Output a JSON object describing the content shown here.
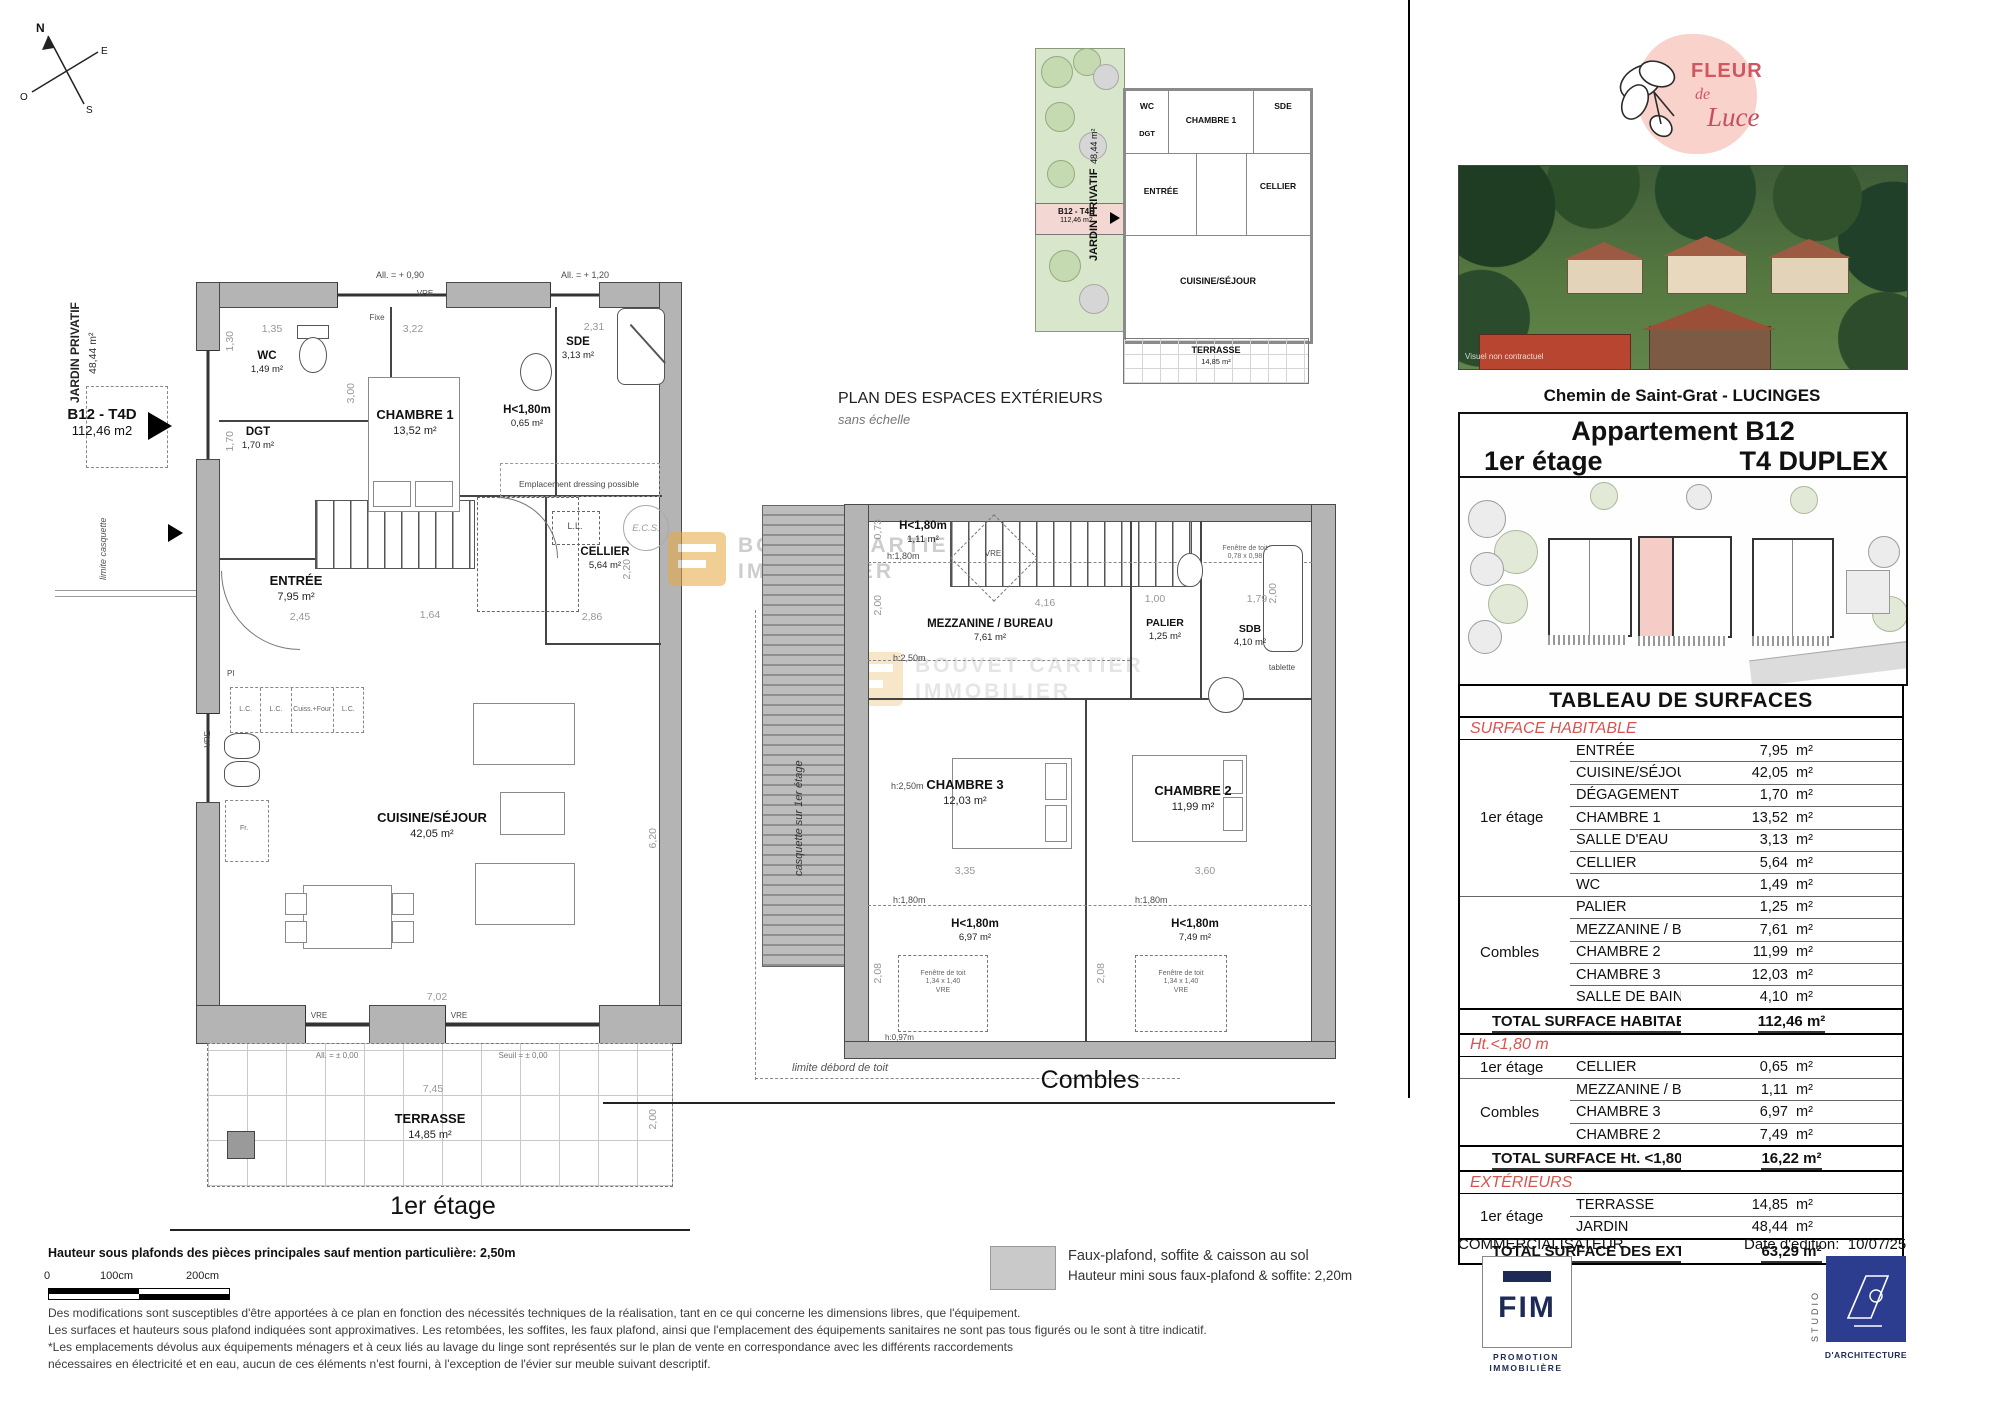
{
  "compass": {
    "n": "N",
    "e": "E",
    "s": "S",
    "o": "O"
  },
  "plan1": {
    "caption": "1er étage",
    "jardin_label": "JARDIN PRIVATIF",
    "jardin_area": "48,44 m²",
    "limite_casquette": "limite casquette",
    "tag_name": "B12 - T4D",
    "tag_area": "112,46 m2",
    "rooms": {
      "wc": {
        "name": "WC",
        "area": "1,49 m²"
      },
      "dgt": {
        "name": "DGT",
        "area": "1,70 m²"
      },
      "ch1": {
        "name": "CHAMBRE 1",
        "area": "13,52 m²"
      },
      "sde": {
        "name": "SDE",
        "area": "3,13 m²"
      },
      "cellier": {
        "name": "CELLIER",
        "area": "5,64 m²"
      },
      "h180": {
        "name": "H<1,80m",
        "area": "0,65 m²"
      },
      "entree": {
        "name": "ENTRÉE",
        "area": "7,95 m²"
      },
      "cuisine": {
        "name": "CUISINE/SÉJOUR",
        "area": "42,05 m²"
      },
      "terrasse": {
        "name": "TERRASSE",
        "area": "14,85 m²"
      }
    },
    "ann": {
      "all090": "All. = + 0,90",
      "all120": "All. = + 1,20",
      "fixe": "Fixe",
      "vre": "VRE",
      "dressing": "Emplacement dressing possible",
      "ll": "L.L.",
      "ecs": "E.C.S.",
      "pi": "PI",
      "lc": "L.C.",
      "cuiss": "Cuiss.+Four",
      "fr": "Fr.",
      "all000": "All. = ± 0,00",
      "seuil": "Seuil = ± 0,00"
    },
    "dims": {
      "d135": "1,35",
      "d322": "3,22",
      "d231": "2,31",
      "d300": "3,00",
      "d130": "1,30",
      "d170": "1,70",
      "d245": "2,45",
      "d164": "1,64",
      "d286": "2,86",
      "d220": "2,20",
      "d620": "6,20",
      "d702": "7,02",
      "d745": "7,45",
      "d200": "2,00"
    }
  },
  "ext_plan": {
    "title": "PLAN DES ESPACES EXTÉRIEURS",
    "subtitle": "sans échelle",
    "jardin_label": "JARDIN PRIVATIF",
    "jardin_area": "48,44 m²",
    "tag_name": "B12 - T4D",
    "tag_area": "112,46 m2",
    "rooms": {
      "wc": "WC",
      "dgt": "DGT",
      "ch1": "CHAMBRE 1",
      "sde": "SDE",
      "entree": "ENTRÉE",
      "cellier": "CELLIER",
      "cuisine": "CUISINE/SÉJOUR",
      "terrasse": "TERRASSE",
      "terrasse_area": "14,85 m²"
    }
  },
  "combles": {
    "caption": "Combles",
    "casquette": "casquette sur 1er étage",
    "limite": "limite débord de toit",
    "rooms": {
      "h_top": {
        "name": "H<1,80m",
        "area": "1,11 m²"
      },
      "mezz": {
        "name": "MEZZANINE / BUREAU",
        "area": "7,61 m²"
      },
      "palier": {
        "name": "PALIER",
        "area": "1,25 m²"
      },
      "sdb": {
        "name": "SDB",
        "area": "4,10 m²"
      },
      "ch3": {
        "name": "CHAMBRE 3",
        "area": "12,03 m²"
      },
      "ch2": {
        "name": "CHAMBRE 2",
        "area": "11,99 m²"
      },
      "h_ch3": {
        "name": "H<1,80m",
        "area": "6,97 m²"
      },
      "h_ch2": {
        "name": "H<1,80m",
        "area": "7,49 m²"
      }
    },
    "ann": {
      "h180": "h:1,80m",
      "h250": "h:2,50m",
      "tablette": "tablette",
      "vre": "VRE",
      "roof_win": "Fenêtre de toit",
      "roof_size": "1,34 x 1,40",
      "roof_small": "Fenêtre de toit",
      "roof_small_size": "0,78 x 0,98",
      "h097": "h:0,97m"
    },
    "dims": {
      "d073": "0,73",
      "d200": "2,00",
      "d416": "4,16",
      "d100": "1,00",
      "d179": "1,79",
      "d335": "3,35",
      "d360": "3,60",
      "d208": "2,08"
    }
  },
  "watermark": {
    "l1": "BOUVET CARTIER",
    "l2": "IMMOBILIER"
  },
  "sidebar": {
    "logo": {
      "l1": "FLEUR",
      "l2": "de",
      "l3": "Luce"
    },
    "photo_note": "Visuel non contractuel",
    "address": "Chemin de Saint-Grat - LUCINGES",
    "apt_title": "Appartement B12",
    "apt_floor": "1er étage",
    "apt_type": "T4 DUPLEX",
    "table": {
      "title": "TABLEAU DE SURFACES",
      "sections": [
        {
          "heading": "SURFACE HABITABLE",
          "groups": [
            {
              "floor": "1er étage",
              "rows": [
                {
                  "label": "ENTRÉE",
                  "value": "7,95",
                  "unit": "m²"
                },
                {
                  "label": "CUISINE/SÉJOUR",
                  "value": "42,05",
                  "unit": "m²"
                },
                {
                  "label": "DÉGAGEMENT",
                  "value": "1,70",
                  "unit": "m²"
                },
                {
                  "label": "CHAMBRE 1",
                  "value": "13,52",
                  "unit": "m²"
                },
                {
                  "label": "SALLE D'EAU",
                  "value": "3,13",
                  "unit": "m²"
                },
                {
                  "label": "CELLIER",
                  "value": "5,64",
                  "unit": "m²"
                },
                {
                  "label": "WC",
                  "value": "1,49",
                  "unit": "m²"
                }
              ]
            },
            {
              "floor": "Combles",
              "rows": [
                {
                  "label": "PALIER",
                  "value": "1,25",
                  "unit": "m²"
                },
                {
                  "label": "MEZZANINE / BUREAU",
                  "value": "7,61",
                  "unit": "m²"
                },
                {
                  "label": "CHAMBRE 2",
                  "value": "11,99",
                  "unit": "m²"
                },
                {
                  "label": "CHAMBRE 3",
                  "value": "12,03",
                  "unit": "m²"
                },
                {
                  "label": "SALLE DE BAINS",
                  "value": "4,10",
                  "unit": "m²"
                }
              ]
            }
          ],
          "total_label": "TOTAL SURFACE HABITABLE",
          "total_value": "112,46 m²"
        },
        {
          "heading": "Ht.<1,80 m",
          "groups": [
            {
              "floor": "1er étage",
              "rows": [
                {
                  "label": "CELLIER",
                  "value": "0,65",
                  "unit": "m²"
                }
              ]
            },
            {
              "floor": "Combles",
              "rows": [
                {
                  "label": "MEZZANINE / BUREAU",
                  "value": "1,11",
                  "unit": "m²"
                },
                {
                  "label": "CHAMBRE 3",
                  "value": "6,97",
                  "unit": "m²"
                },
                {
                  "label": "CHAMBRE 2",
                  "value": "7,49",
                  "unit": "m²"
                }
              ]
            }
          ],
          "total_label": "TOTAL SURFACE Ht. <1,80 m",
          "total_value": "16,22 m²"
        },
        {
          "heading": "EXTÉRIEURS",
          "groups": [
            {
              "floor": "1er étage",
              "rows": [
                {
                  "label": "TERRASSE",
                  "value": "14,85",
                  "unit": "m²"
                },
                {
                  "label": "JARDIN",
                  "value": "48,44",
                  "unit": "m²"
                }
              ]
            }
          ],
          "total_label": "TOTAL SURFACE DES EXTÉRIEURS",
          "total_value": "63,29 m²"
        }
      ]
    },
    "commercial": "COMMERCIALISATEUR",
    "date_label": "Date d'édition:",
    "date_value": "10/07/25",
    "fim_name": "FIM",
    "fim_sub1": "PROMOTION",
    "fim_sub2": "IMMOBILIÈRE",
    "studio_vert": "STUDIO",
    "studio_sub": "D'ARCHITECTURE"
  },
  "footer": {
    "height_note": "Hauteur sous plafonds des pièces principales sauf mention particulière: 2,50m",
    "scale0": "0",
    "scale100": "100cm",
    "scale200": "200cm",
    "legend1": "Faux-plafond, soffite & caisson au sol",
    "legend2": "Hauteur mini sous faux-plafond & soffite: 2,20m",
    "disc1": "Des modifications sont susceptibles d'être apportées à ce plan en fonction des nécessités techniques de la réalisation, tant en ce qui concerne les dimensions libres, que l'équipement.",
    "disc2": "Les surfaces et hauteurs sous plafond indiquées sont approximatives. Les retombées, les soffites, les faux plafond, ainsi que l'emplacement des équipements sanitaires ne sont pas tous figurés ou le sont à titre indicatif.",
    "disc3": "*Les emplacements dévolus aux équipements ménagers et à ceux liés au lavage du linge sont représentés sur le plan de vente en correspondance avec les différents raccordements",
    "disc4": "nécessaires en électricité et en eau, aucun de ces éléments n'est fourni, à l'exception de l'évier sur meuble suivant descriptif."
  }
}
